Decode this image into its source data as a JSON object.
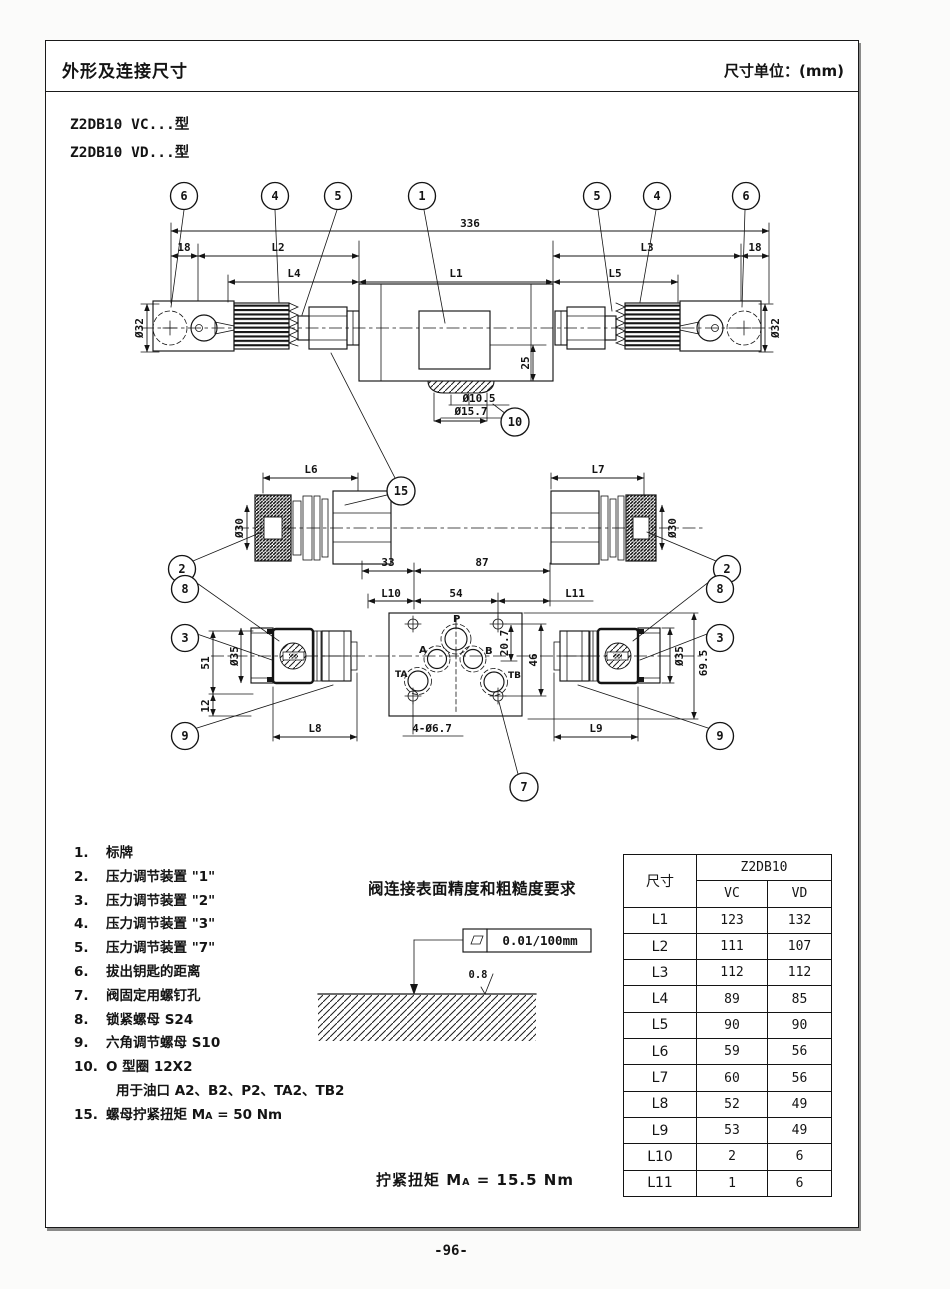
{
  "header": {
    "title": "外形及连接尺寸",
    "unit": "尺寸单位：(mm)"
  },
  "models": {
    "vc": "Z2DB10 VC...型",
    "vd": "Z2DB10 VD...型"
  },
  "drawing": {
    "balloons": {
      "b1": "1",
      "b2": "2",
      "b3": "3",
      "b4": "4",
      "b5": "5",
      "b6": "6",
      "b7": "7",
      "b8": "8",
      "b9": "9",
      "b10": "10",
      "b15": "15"
    },
    "dims": {
      "overall": "336",
      "end": "18",
      "L1": "L1",
      "L2": "L2",
      "L3": "L3",
      "L4": "L4",
      "L5": "L5",
      "L6": "L6",
      "L7": "L7",
      "L8": "L8",
      "L9": "L9",
      "L10": "L10",
      "L11": "L11",
      "dia32": "Ø32",
      "dia30": "Ø30",
      "dia35": "Ø35",
      "dia105": "Ø10.5",
      "dia157": "Ø15.7",
      "d25": "25",
      "d33": "33",
      "d87": "87",
      "d54": "54",
      "d207": "20.7",
      "d46": "46",
      "d51": "51",
      "d12": "12",
      "d695": "69.5",
      "holes": "4-Ø6.7"
    },
    "ports": {
      "p": "P",
      "a": "A",
      "b": "B",
      "ta": "TA",
      "tb": "TB"
    }
  },
  "parts": {
    "items": [
      {
        "num": "1.",
        "text": "标牌"
      },
      {
        "num": "2.",
        "text": "压力调节装置 \"1\""
      },
      {
        "num": "3.",
        "text": "压力调节装置 \"2\""
      },
      {
        "num": "4.",
        "text": "压力调节装置 \"3\""
      },
      {
        "num": "5.",
        "text": "压力调节装置 \"7\""
      },
      {
        "num": "6.",
        "text": "拔出钥匙的距离"
      },
      {
        "num": "7.",
        "text": "阀固定用螺钉孔"
      },
      {
        "num": "8.",
        "text": "锁紧螺母 S24"
      },
      {
        "num": "9.",
        "text": "六角调节螺母 S10"
      },
      {
        "num": "10.",
        "text": "O 型圈 12X2"
      },
      {
        "num": "",
        "text": "用于油口 A2、B2、P2、TA2、TB2"
      }
    ],
    "item15": {
      "num": "15.",
      "pre": "螺母拧紧扭矩 M",
      "sub": "A",
      "post": " = 50 Nm"
    }
  },
  "surface": {
    "title": "阀连接表面精度和粗糙度要求",
    "flatness": "0.01/100mm",
    "roughness": "0.8"
  },
  "torque": {
    "pre": "拧紧扭矩 M",
    "sub": "A",
    "post": " = 15.5 Nm"
  },
  "table": {
    "dim_header": "尺寸",
    "group_header": "Z2DB10",
    "cols": [
      "VC",
      "VD"
    ],
    "rows": [
      {
        "dim": "L1",
        "vc": "123",
        "vd": "132"
      },
      {
        "dim": "L2",
        "vc": "111",
        "vd": "107"
      },
      {
        "dim": "L3",
        "vc": "112",
        "vd": "112"
      },
      {
        "dim": "L4",
        "vc": "89",
        "vd": "85"
      },
      {
        "dim": "L5",
        "vc": "90",
        "vd": "90"
      },
      {
        "dim": "L6",
        "vc": "59",
        "vd": "56"
      },
      {
        "dim": "L7",
        "vc": "60",
        "vd": "56"
      },
      {
        "dim": "L8",
        "vc": "52",
        "vd": "49"
      },
      {
        "dim": "L9",
        "vc": "53",
        "vd": "49"
      },
      {
        "dim": "L10",
        "vc": "2",
        "vd": "6"
      },
      {
        "dim": "L11",
        "vc": "1",
        "vd": "6"
      }
    ]
  },
  "footer": {
    "page_number": "-96-"
  }
}
